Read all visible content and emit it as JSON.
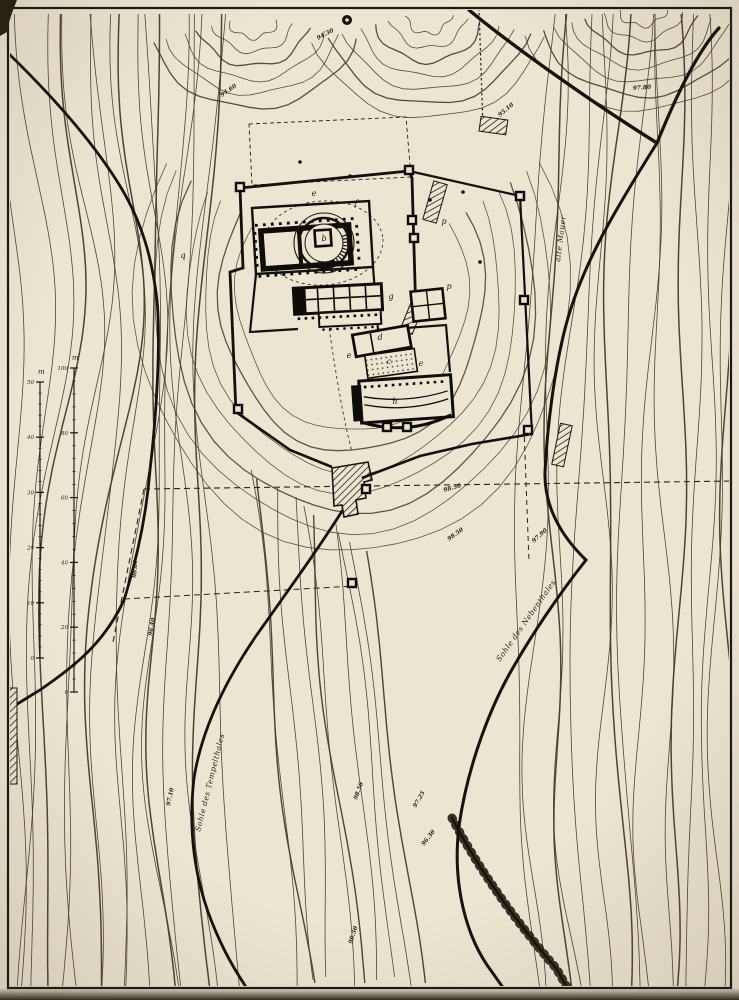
{
  "map": {
    "description": "Contour plan of sanctuary hill with temple precinct",
    "colors": {
      "paper": "#ece5d1",
      "contour_ink": "#463c2c",
      "bold_ink": "#17120a",
      "text_ink": "#241e14"
    },
    "region_labels": [
      {
        "text": "alte Mauer",
        "x": 560,
        "y": 262,
        "rot": -83,
        "size": 7.5
      },
      {
        "text": "Sohle des Nebenthales",
        "x": 500,
        "y": 662,
        "rot": -55,
        "size": 7.5
      },
      {
        "text": "Sohle des Tempelthales",
        "x": 200,
        "y": 832,
        "rot": -76,
        "size": 7.5
      }
    ],
    "elevation_labels": [
      {
        "text": "94.60",
        "x": 222,
        "y": 97,
        "rot": -35
      },
      {
        "text": "94.30",
        "x": 318,
        "y": 40,
        "rot": -28
      },
      {
        "text": "95.10",
        "x": 500,
        "y": 117,
        "rot": -40
      },
      {
        "text": "97.80",
        "x": 633,
        "y": 90,
        "rot": -4
      },
      {
        "text": "98.50",
        "x": 444,
        "y": 492,
        "rot": -16
      },
      {
        "text": "98.50",
        "x": 449,
        "y": 541,
        "rot": -36
      },
      {
        "text": "97.90",
        "x": 534,
        "y": 543,
        "rot": -42
      },
      {
        "text": "98.60",
        "x": 136,
        "y": 578,
        "rot": -86
      },
      {
        "text": "96.40",
        "x": 152,
        "y": 636,
        "rot": -80
      },
      {
        "text": "97.10",
        "x": 170,
        "y": 806,
        "rot": -78
      },
      {
        "text": "98.50",
        "x": 357,
        "y": 800,
        "rot": -70
      },
      {
        "text": "97.25",
        "x": 416,
        "y": 808,
        "rot": -60
      },
      {
        "text": "96.30",
        "x": 424,
        "y": 846,
        "rot": -52
      },
      {
        "text": "99.50",
        "x": 352,
        "y": 944,
        "rot": -72
      }
    ],
    "plan_letters": [
      {
        "text": "e",
        "x": 314,
        "y": 196
      },
      {
        "text": "f",
        "x": 356,
        "y": 206
      },
      {
        "text": "q",
        "x": 183,
        "y": 258
      },
      {
        "text": "p",
        "x": 449,
        "y": 289
      },
      {
        "text": "g",
        "x": 391,
        "y": 299
      },
      {
        "text": "d",
        "x": 380,
        "y": 340
      },
      {
        "text": "c",
        "x": 389,
        "y": 364
      },
      {
        "text": "e",
        "x": 349,
        "y": 358
      },
      {
        "text": "e",
        "x": 421,
        "y": 366
      },
      {
        "text": "h",
        "x": 395,
        "y": 404
      },
      {
        "text": "b",
        "x": 324,
        "y": 241
      },
      {
        "text": "n",
        "x": 258,
        "y": 278
      },
      {
        "text": "p",
        "x": 444,
        "y": 224
      }
    ],
    "scale_bars": [
      {
        "unit": "m",
        "ticks": [
          "50",
          "40",
          "30",
          "20",
          "10",
          "0"
        ]
      },
      {
        "unit": "m",
        "ticks": [
          "100",
          "80",
          "60",
          "40",
          "20",
          "0"
        ]
      }
    ]
  }
}
